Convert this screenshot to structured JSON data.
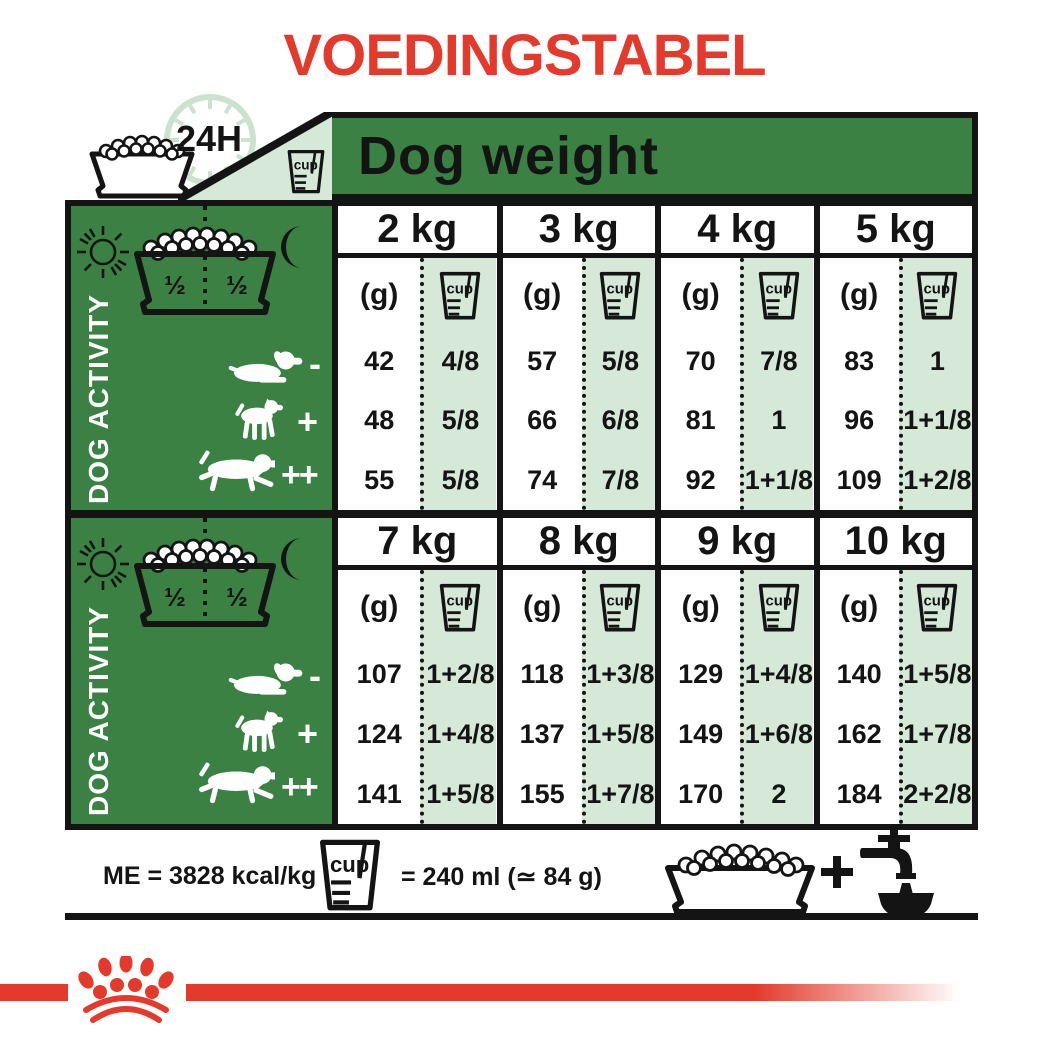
{
  "title": "VOEDINGSTABEL",
  "colors": {
    "red": "#e43a2b",
    "green": "#3a8143",
    "mint": "#d6e9d9",
    "ink": "#141414"
  },
  "header": {
    "dog_weight": "Dog weight",
    "duration": "24H"
  },
  "labels": {
    "cup": "cup",
    "grams_unit": "(g)",
    "half": "½"
  },
  "activity": {
    "panel_label": "DOG ACTIVITY",
    "levels": [
      "-",
      "+",
      "++"
    ]
  },
  "sections": [
    {
      "columns": [
        {
          "weight": "2 kg",
          "grams": [
            "42",
            "48",
            "55"
          ],
          "cups": [
            "4/8",
            "5/8",
            "5/8"
          ]
        },
        {
          "weight": "3 kg",
          "grams": [
            "57",
            "66",
            "74"
          ],
          "cups": [
            "5/8",
            "6/8",
            "7/8"
          ]
        },
        {
          "weight": "4 kg",
          "grams": [
            "70",
            "81",
            "92"
          ],
          "cups": [
            "7/8",
            "1",
            "1+1/8"
          ]
        },
        {
          "weight": "5 kg",
          "grams": [
            "83",
            "96",
            "109"
          ],
          "cups": [
            "1",
            "1+1/8",
            "1+2/8"
          ]
        }
      ]
    },
    {
      "columns": [
        {
          "weight": "7 kg",
          "grams": [
            "107",
            "124",
            "141"
          ],
          "cups": [
            "1+2/8",
            "1+4/8",
            "1+5/8"
          ]
        },
        {
          "weight": "8 kg",
          "grams": [
            "118",
            "137",
            "155"
          ],
          "cups": [
            "1+3/8",
            "1+5/8",
            "1+7/8"
          ]
        },
        {
          "weight": "9 kg",
          "grams": [
            "129",
            "149",
            "170"
          ],
          "cups": [
            "1+4/8",
            "1+6/8",
            "2"
          ]
        },
        {
          "weight": "10 kg",
          "grams": [
            "140",
            "162",
            "184"
          ],
          "cups": [
            "1+5/8",
            "1+7/8",
            "2+2/8"
          ]
        }
      ]
    }
  ],
  "footer": {
    "me": "ME = 3828 kcal/kg",
    "cup_equiv": "= 240 ml (≃ 84 g)"
  }
}
